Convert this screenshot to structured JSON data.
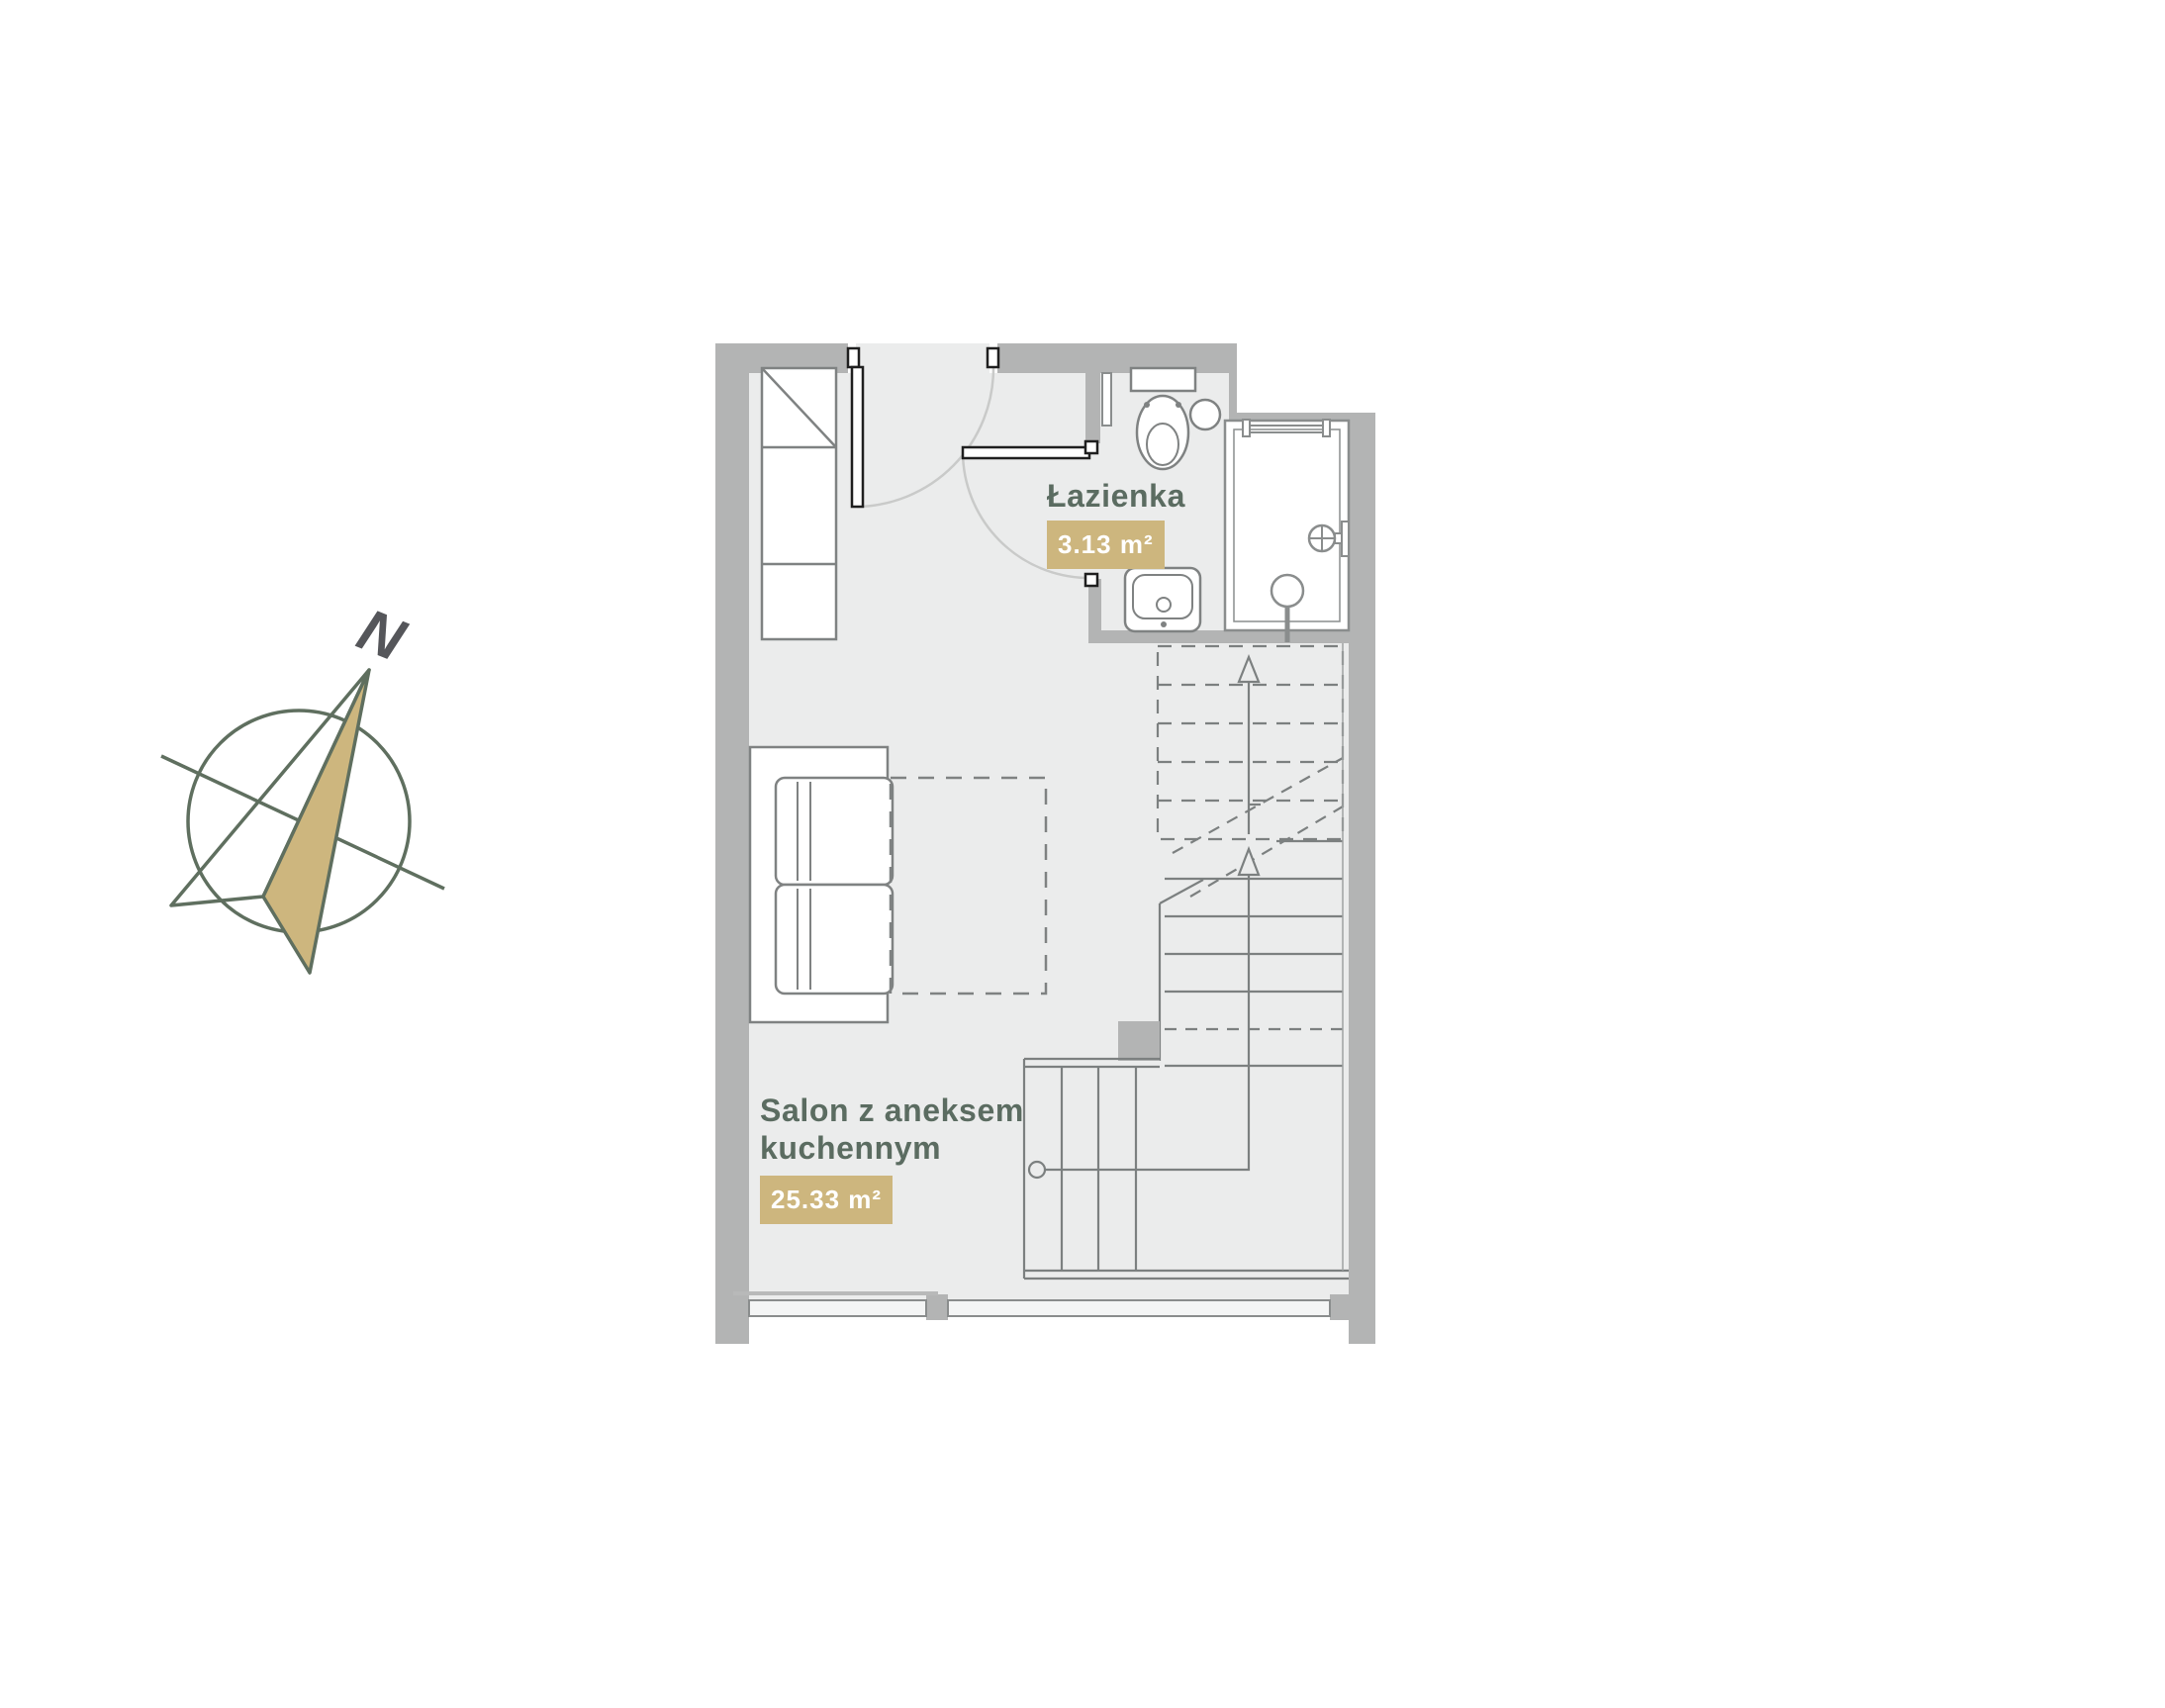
{
  "compass": {
    "north_label": "N"
  },
  "rooms": [
    {
      "id": "salon",
      "name_line1": "Salon z aneksem",
      "name_line2": "kuchennym",
      "area": "25.33 m²"
    },
    {
      "id": "lazienka",
      "name": "Łazienka",
      "area": "3.13 m²"
    }
  ],
  "colors": {
    "wall": "#b3b4b4",
    "floor": "#ebecec",
    "furniture_outline": "#7f8282",
    "fixture_outline": "#8a8d8d",
    "door": "#1f1f1f",
    "swing_arc": "#c9cac9",
    "stairs_line": "#7c8080",
    "label_text": "#5b6c61",
    "area_badge": "#cdb67e",
    "badge_text": "#ffffff",
    "compass_outline": "#5f6f5f",
    "compass_fill": "#cdb67e",
    "north_letter": "#55565a"
  }
}
